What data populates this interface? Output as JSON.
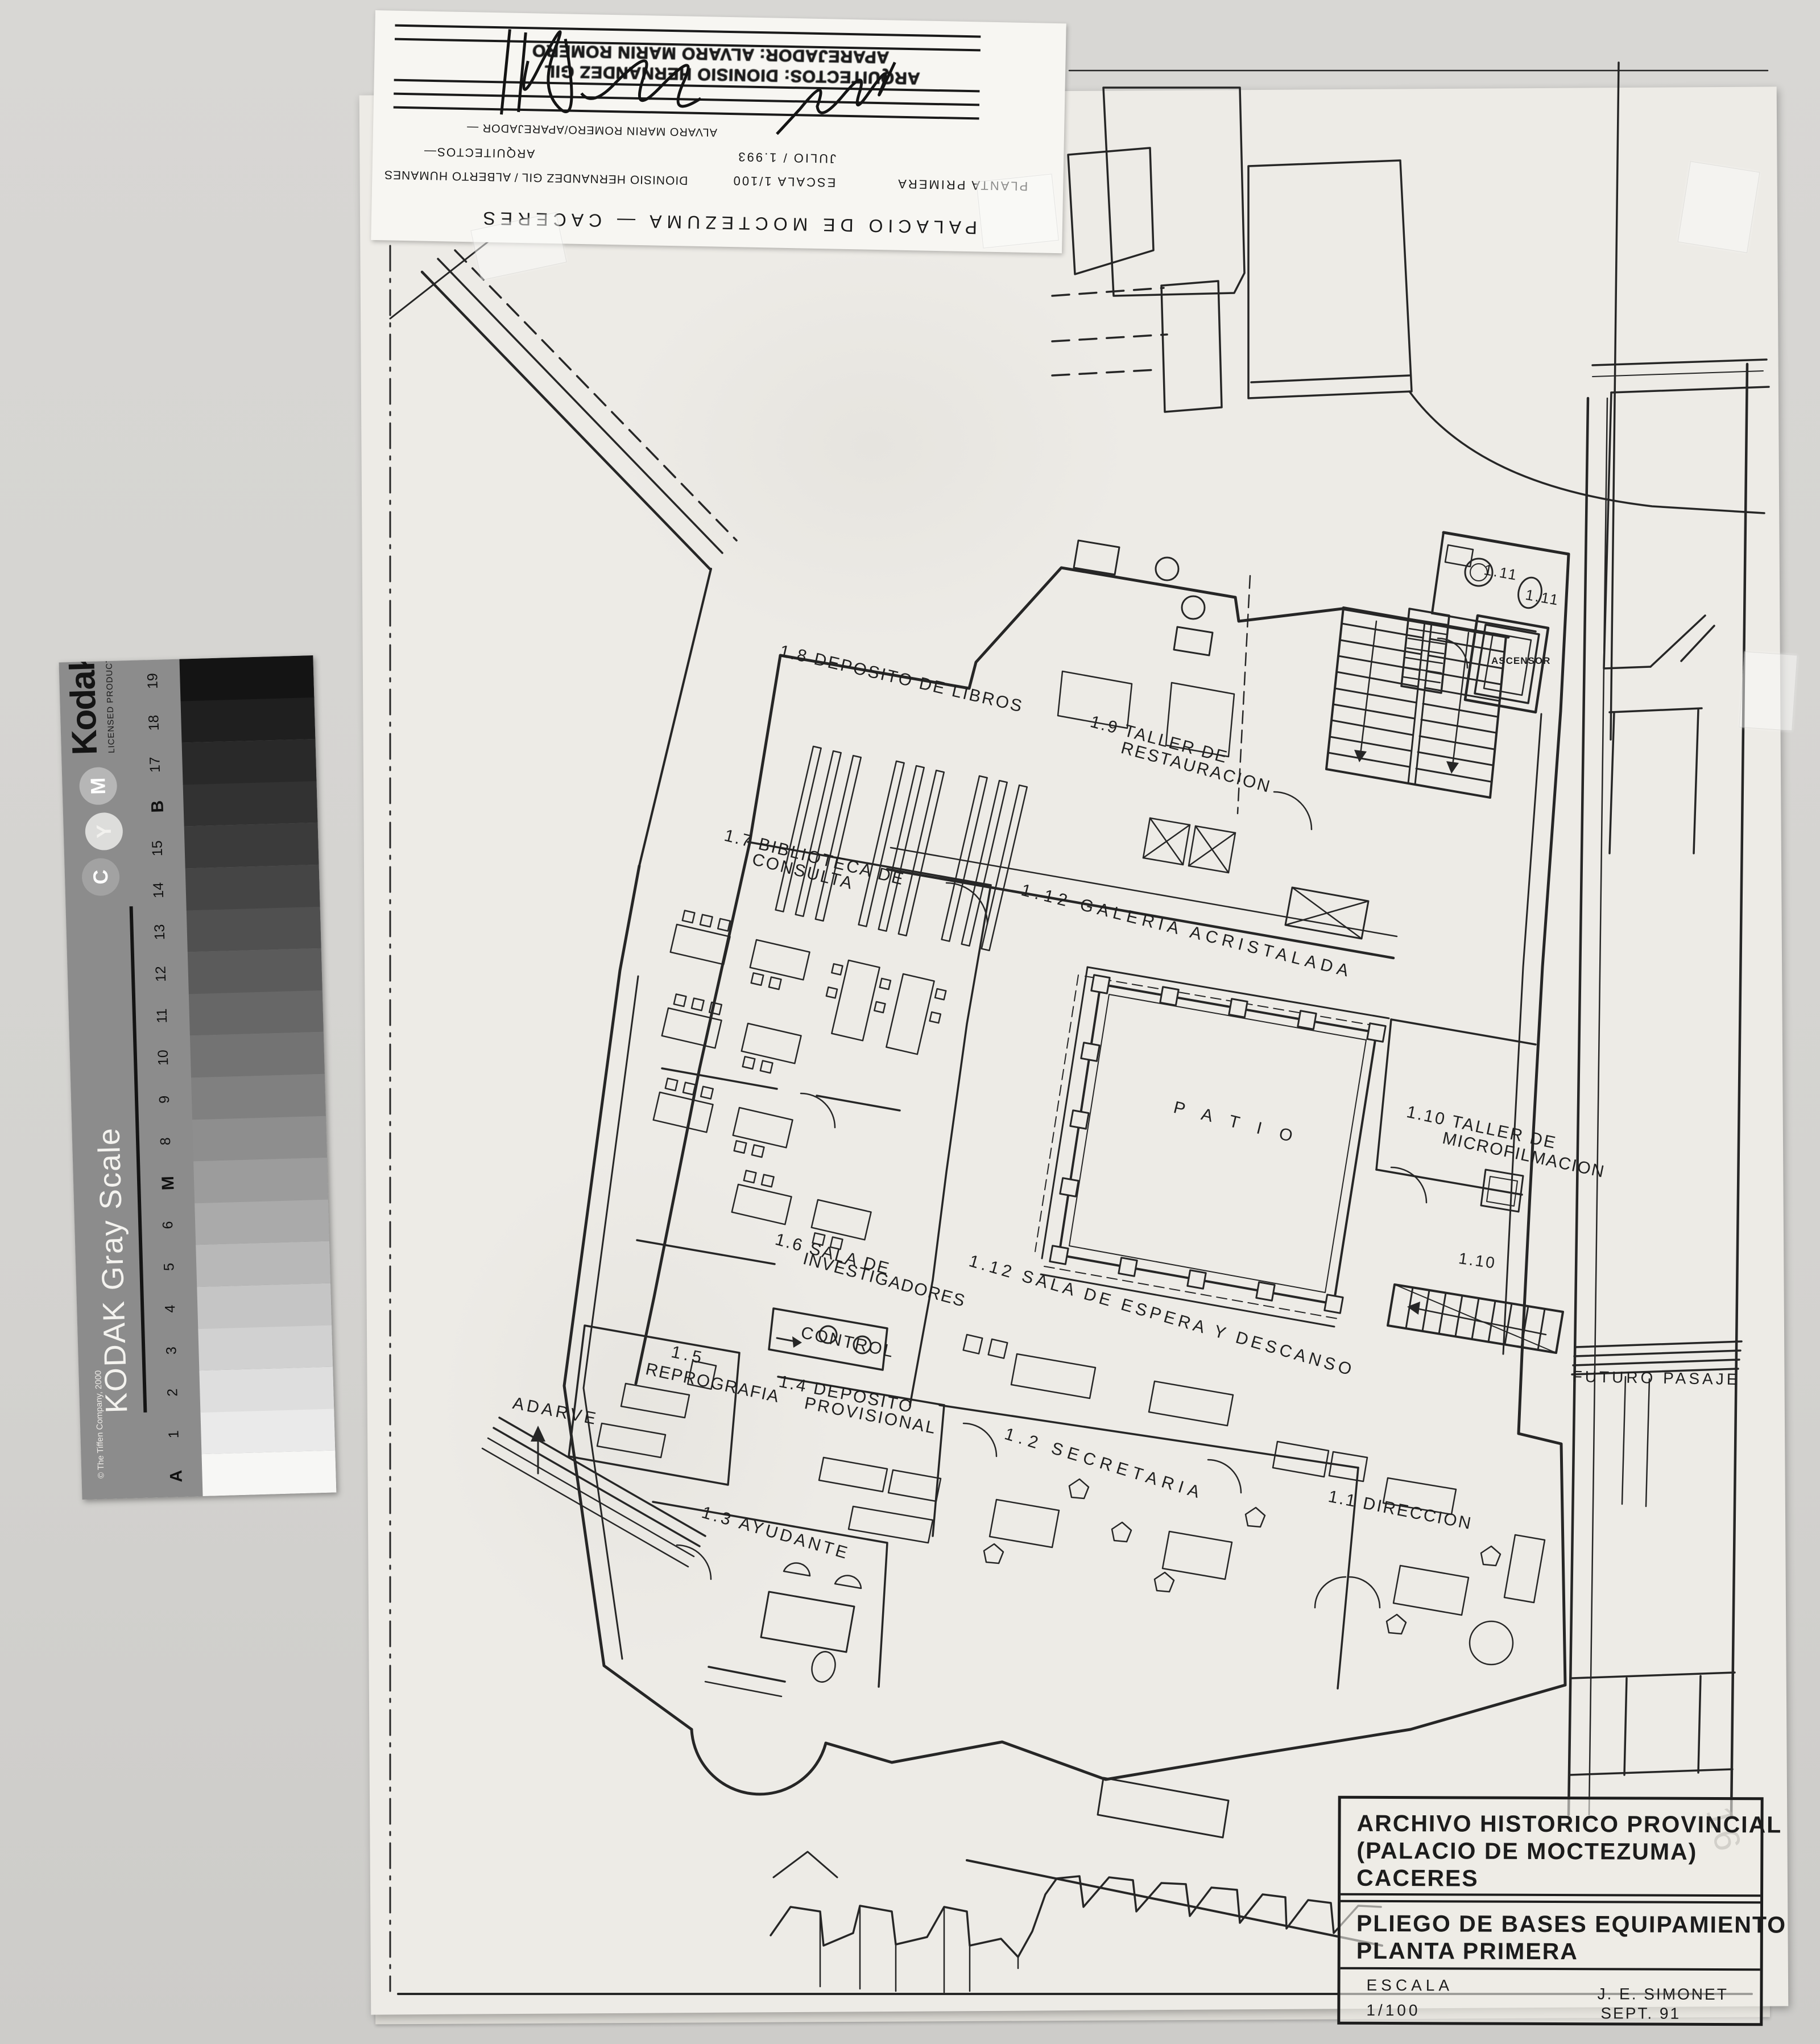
{
  "scan": {
    "background_color": "#d4d3d0",
    "sheet_color": "#edebe6",
    "ink_color": "#262626"
  },
  "title_strip": {
    "project_line": "PALACIO DE MOCTEZUMA — CACERES",
    "planta": "PLANTA PRIMERA",
    "escala": "ESCALA 1/100",
    "arquitectos_names": "DIONISIO HERNANDEZ GIL / ALBERTO HUMANES",
    "fecha": "JULIO / 1.993",
    "arquitectos": "ARQUITECTOS—",
    "aparejador": "ALVARO MARIN ROMERO/APAREJADOR —",
    "stamp_line1": "ARQUITECTOS: DIONISIO HERNANDEZ GIL",
    "stamp_line2": "APAREJADOR: ALVARO MARIN ROMERO"
  },
  "kodak": {
    "brand": "Kodak",
    "licensed": "LICENSED PRODUCT",
    "scale_title": "KODAK Gray Scale",
    "copyright": "© The Tiffen Company, 2000",
    "circles": [
      "C",
      "Y",
      "M"
    ],
    "circle_grays": [
      "#a2a2a2",
      "#dddddb",
      "#b6b6b6"
    ],
    "step_labels": [
      "A",
      "1",
      "2",
      "3",
      "4",
      "5",
      "6",
      "M",
      "8",
      "9",
      "10",
      "11",
      "12",
      "13",
      "14",
      "15",
      "B",
      "17",
      "18",
      "19"
    ],
    "step_grays": [
      "#f7f7f5",
      "#eaeaea",
      "#dedede",
      "#d1d1d1",
      "#c5c5c5",
      "#b8b8b8",
      "#aaaaaa",
      "#9c9c9c",
      "#8e8e8e",
      "#808080",
      "#737373",
      "#676767",
      "#5b5b5b",
      "#505050",
      "#454545",
      "#3b3b3b",
      "#323232",
      "#292929",
      "#1f1f1f",
      "#141414"
    ],
    "strip_color": "#8c8c8c"
  },
  "plan": {
    "labels": [
      {
        "text": "1.8 DEPOSITO DE LIBROS"
      },
      {
        "text": "1.9 TALLER DE"
      },
      {
        "text": "RESTAURACION"
      },
      {
        "text": "1.7 BIBLIOTECA DE"
      },
      {
        "text": "CONSULTA"
      },
      {
        "text": "1.12 GALERIA ACRISTALADA"
      },
      {
        "text": "P A T I O"
      },
      {
        "text": "1.10 TALLER DE"
      },
      {
        "text": "MICROFILMACION"
      },
      {
        "text": "1.6 SALA DE"
      },
      {
        "text": "INVESTIGADORES"
      },
      {
        "text": "1.12 SALA DE ESPERA Y DESCANSO"
      },
      {
        "text": "CONTROL"
      },
      {
        "text": "1.5"
      },
      {
        "text": "REPROGRAFIA"
      },
      {
        "text": "1.4 DEPOSITO"
      },
      {
        "text": "PROVISIONAL"
      },
      {
        "text": "ADARVE"
      },
      {
        "text": "1.2 SECRETARIA"
      },
      {
        "text": "1.1 DIRECCION"
      },
      {
        "text": "1.3 AYUDANTE"
      },
      {
        "text": "FUTURO PASAJE"
      },
      {
        "text": "1.10"
      },
      {
        "text": "1.11"
      },
      {
        "text": "1.11"
      },
      {
        "text": "ASCENSOR"
      }
    ]
  },
  "title_block": {
    "line1": "ARCHIVO HISTORICO PROVINCIAL",
    "line2": "(PALACIO DE MOCTEZUMA)",
    "line3": "CACERES",
    "line4": "PLIEGO DE BASES  EQUIPAMIENTO",
    "line5": "PLANTA PRIMERA",
    "escala_label": "ESCALA",
    "escala_value": "1/100",
    "author": "J. E. SIMONET",
    "date": "SEPT.  91",
    "pencil_note": "16"
  }
}
